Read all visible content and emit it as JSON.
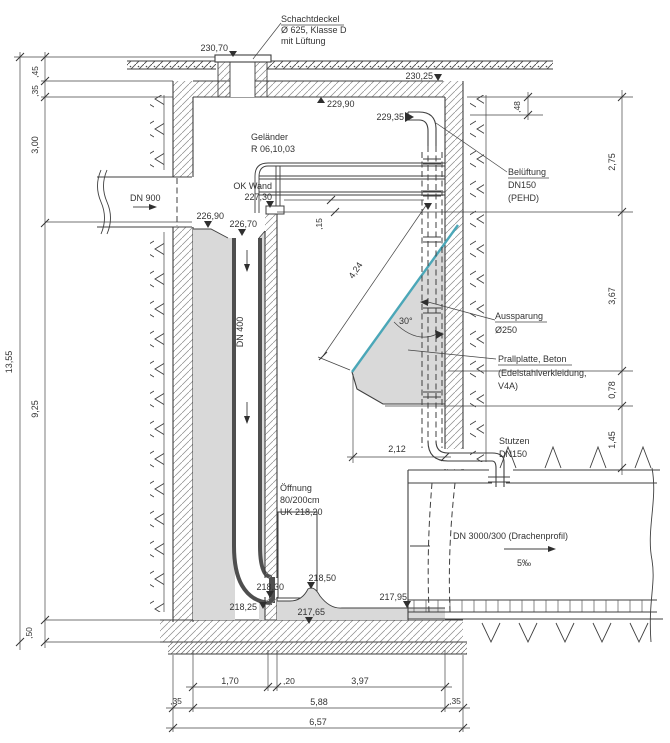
{
  "drawing_type": "technical-section-drawing",
  "colors": {
    "line": "#3f3f3f",
    "concrete_fill": "#d9d9d9",
    "accent_blue": "#4ba7b8",
    "dim_text": "#333333"
  },
  "callouts": {
    "schachtdeckel": [
      "Schachtdeckel",
      "Ø 625, Klasse D",
      "mit Lüftung"
    ],
    "gelaender": [
      "Geländer",
      "R 06,10,03"
    ],
    "ok_wand": [
      "OK Wand",
      "227,30"
    ],
    "belueftung": [
      "Belüftung",
      "DN150",
      "(PEHD)"
    ],
    "aussparung": [
      "Aussparung",
      "Ø250"
    ],
    "prallplatte": [
      "Prallplatte, Beton",
      "(Edelstahlverkleidung,",
      "V4A)"
    ],
    "stutzen": [
      "Stutzen",
      "DN150"
    ],
    "oeffnung": [
      "Öffnung",
      "80/200cm",
      "UK 218,20"
    ],
    "dn900": "DN 900",
    "dn400": "DN 400",
    "dn3000": "DN 3000/300 (Drachenprofil)",
    "slope": "5‰"
  },
  "elevations": {
    "e23070": "230,70",
    "e23025": "230,25",
    "e22990": "229,90",
    "e22935": "229,35",
    "e22690": "226,90",
    "e22670": "226,70",
    "e21830": "218,30",
    "e21850": "218,50",
    "e21825": "218,25",
    "e21765": "217,65",
    "e21795": "217,95"
  },
  "dimensions": {
    "left_total": "13,55",
    "left_segments": [
      ",45",
      ",35",
      "3,00",
      "9,25",
      ",50"
    ],
    "right_segments": [
      ",48",
      "2,75",
      "3,67",
      "0,78",
      "1,45"
    ],
    "plate_length": "4,24",
    "plate_angle": "30°",
    "plate_offset": "2,12",
    "wall_gap": ",15",
    "bottom_row1": [
      "1,70",
      ",20",
      "3,97"
    ],
    "bottom_row2": [
      ",35",
      "5,88",
      ",35"
    ],
    "bottom_total": "6,57"
  }
}
